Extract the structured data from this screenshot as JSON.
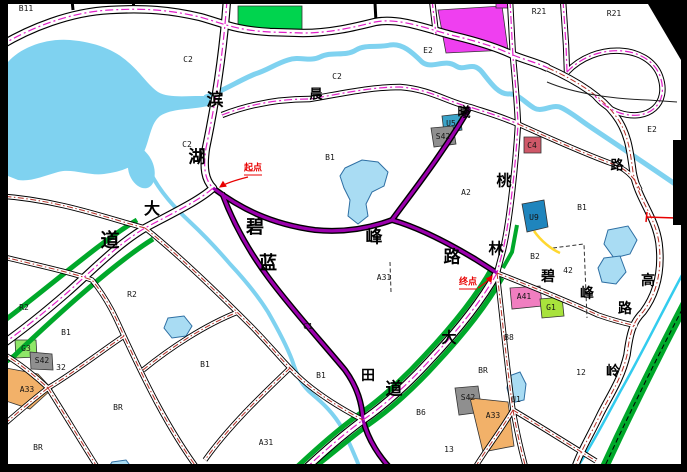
{
  "colors": {
    "frame": "#000000",
    "canvas": "#ffffff",
    "water": "#7fd2f0",
    "pond": "#a9dcf3",
    "water_edge": "#2e6fa3",
    "river_thin": "#33ccee",
    "green_belt": "#00a82a",
    "road_casing": "#000000",
    "road_fill": "#ffffff",
    "centerline_major": "#e020c8",
    "centerline_minor": "#b83028",
    "road_solid_purple": "#9b00ad",
    "annotation_red": "#e80000",
    "yellow_line": "#ffd830"
  },
  "annotations": {
    "start": {
      "label": "起点"
    },
    "end": {
      "label": "终点"
    }
  },
  "road_name_characters": [
    {
      "ch": "滨",
      "x": 215,
      "y": 100,
      "s": 17
    },
    {
      "ch": "湖",
      "x": 197,
      "y": 157,
      "s": 17
    },
    {
      "ch": "大",
      "x": 152,
      "y": 210,
      "s": 16
    },
    {
      "ch": "道",
      "x": 110,
      "y": 241,
      "s": 19
    },
    {
      "ch": "晨",
      "x": 316,
      "y": 94,
      "s": 13
    },
    {
      "ch": "曦",
      "x": 464,
      "y": 112,
      "s": 13
    },
    {
      "ch": "碧",
      "x": 255,
      "y": 227,
      "s": 18
    },
    {
      "ch": "蓝",
      "x": 268,
      "y": 263,
      "s": 18
    },
    {
      "ch": "峰",
      "x": 374,
      "y": 237,
      "s": 17
    },
    {
      "ch": "路",
      "x": 452,
      "y": 257,
      "s": 17
    },
    {
      "ch": "桃",
      "x": 504,
      "y": 182,
      "s": 15
    },
    {
      "ch": "林",
      "x": 496,
      "y": 250,
      "s": 15
    },
    {
      "ch": "大",
      "x": 449,
      "y": 339,
      "s": 15
    },
    {
      "ch": "田",
      "x": 368,
      "y": 377,
      "s": 14
    },
    {
      "ch": "道",
      "x": 394,
      "y": 389,
      "s": 17
    },
    {
      "ch": "碧",
      "x": 548,
      "y": 278,
      "s": 14
    },
    {
      "ch": "峰",
      "x": 587,
      "y": 295,
      "s": 14
    },
    {
      "ch": "路",
      "x": 625,
      "y": 310,
      "s": 14
    },
    {
      "ch": "高",
      "x": 648,
      "y": 282,
      "s": 14
    },
    {
      "ch": "岭",
      "x": 613,
      "y": 373,
      "s": 14
    },
    {
      "ch": "路",
      "x": 617,
      "y": 165,
      "s": 13
    }
  ],
  "parcel_labels": [
    {
      "text": "B11",
      "x": 26,
      "y": 9
    },
    {
      "text": "C2",
      "x": 188,
      "y": 60
    },
    {
      "text": "C2",
      "x": 337,
      "y": 77
    },
    {
      "text": "E2",
      "x": 428,
      "y": 51
    },
    {
      "text": "R21",
      "x": 539,
      "y": 12
    },
    {
      "text": "R21",
      "x": 614,
      "y": 14
    },
    {
      "text": "E2",
      "x": 652,
      "y": 130
    },
    {
      "text": "C2",
      "x": 187,
      "y": 145
    },
    {
      "text": "U5",
      "x": 451,
      "y": 124
    },
    {
      "text": "S42",
      "x": 443,
      "y": 137
    },
    {
      "text": "C4",
      "x": 532,
      "y": 146
    },
    {
      "text": "B1",
      "x": 330,
      "y": 158
    },
    {
      "text": "A2",
      "x": 466,
      "y": 193
    },
    {
      "text": "B1",
      "x": 582,
      "y": 208
    },
    {
      "text": "U9",
      "x": 534,
      "y": 218
    },
    {
      "text": "B2",
      "x": 535,
      "y": 257
    },
    {
      "text": "42",
      "x": 568,
      "y": 271
    },
    {
      "text": "A31",
      "x": 384,
      "y": 278
    },
    {
      "text": "A41",
      "x": 524,
      "y": 297
    },
    {
      "text": "G1",
      "x": 551,
      "y": 308
    },
    {
      "text": "B8",
      "x": 509,
      "y": 338
    },
    {
      "text": "C1",
      "x": 308,
      "y": 327
    },
    {
      "text": "R2",
      "x": 132,
      "y": 295
    },
    {
      "text": "R2",
      "x": 24,
      "y": 308
    },
    {
      "text": "B1",
      "x": 66,
      "y": 333
    },
    {
      "text": "G3",
      "x": 26,
      "y": 349
    },
    {
      "text": "S42",
      "x": 42,
      "y": 361
    },
    {
      "text": "32",
      "x": 61,
      "y": 368
    },
    {
      "text": "A33",
      "x": 27,
      "y": 390
    },
    {
      "text": "BR",
      "x": 118,
      "y": 408
    },
    {
      "text": "BR",
      "x": 38,
      "y": 448
    },
    {
      "text": "B1",
      "x": 205,
      "y": 365
    },
    {
      "text": "B1",
      "x": 321,
      "y": 376
    },
    {
      "text": "A31",
      "x": 266,
      "y": 443
    },
    {
      "text": "B6",
      "x": 421,
      "y": 413
    },
    {
      "text": "13",
      "x": 449,
      "y": 450
    },
    {
      "text": "BR",
      "x": 483,
      "y": 371
    },
    {
      "text": "S42",
      "x": 468,
      "y": 398
    },
    {
      "text": "A33",
      "x": 493,
      "y": 416
    },
    {
      "text": "U1",
      "x": 516,
      "y": 400
    },
    {
      "text": "12",
      "x": 581,
      "y": 373
    }
  ],
  "zones": [
    {
      "id": "green-space-top",
      "color": "#00d44e"
    },
    {
      "id": "magenta-parcel-top",
      "color": "#ef3ff0"
    },
    {
      "id": "magenta-parcel-small",
      "color": "#ef3ff0"
    },
    {
      "id": "utility-block-u5",
      "color": "#3aa3c8"
    },
    {
      "id": "transport-block-s42-north",
      "color": "#8f8f8f"
    },
    {
      "id": "block-c4",
      "color": "#cf5868"
    },
    {
      "id": "utility-block-u9",
      "color": "#1f85bd"
    },
    {
      "id": "block-a41",
      "color": "#f07ec0"
    },
    {
      "id": "green-block-g1",
      "color": "#a8e23c"
    },
    {
      "id": "green-block-g3",
      "color": "#8fe668"
    },
    {
      "id": "transport-block-s42-west",
      "color": "#8f8f8f"
    },
    {
      "id": "block-a33-west",
      "color": "#f2b169"
    },
    {
      "id": "transport-block-s42-south",
      "color": "#8f8f8f"
    },
    {
      "id": "block-a33-south",
      "color": "#f2b169"
    }
  ]
}
